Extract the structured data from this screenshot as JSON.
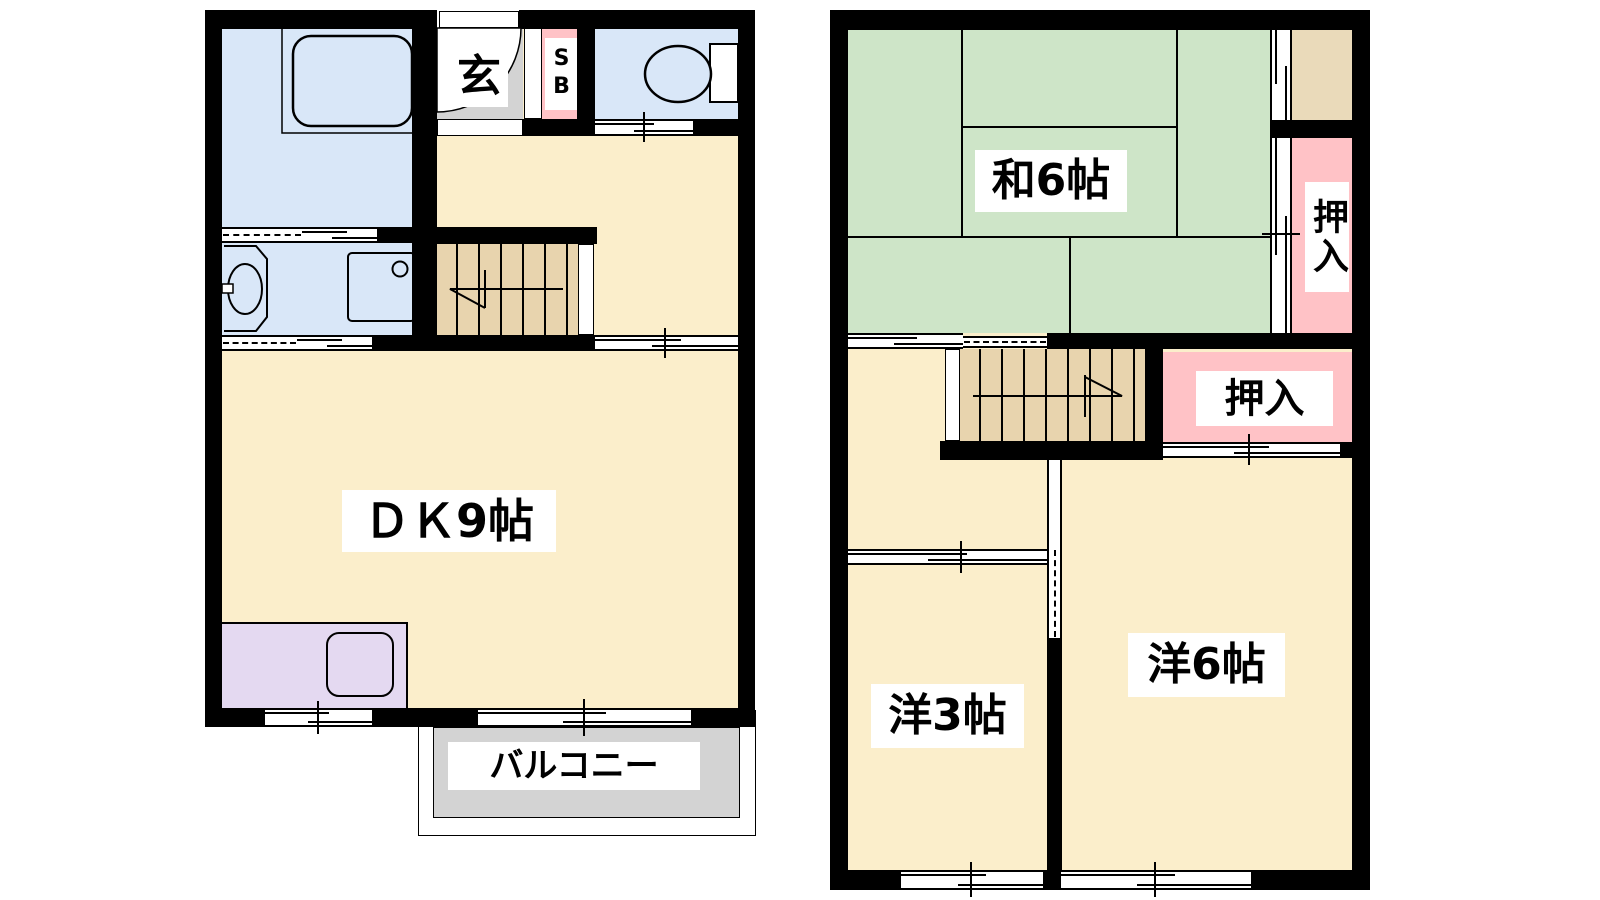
{
  "floor1": {
    "rooms": {
      "dining_kitchen": {
        "label": "ＤＫ9帖"
      },
      "entrance": {
        "label": "玄"
      },
      "shoe_box": {
        "label": "SB"
      },
      "balcony": {
        "label": "バルコニー"
      }
    }
  },
  "floor2": {
    "rooms": {
      "japanese_room": {
        "label": "和6帖"
      },
      "closet_upper": {
        "label": "押入"
      },
      "closet_lower": {
        "label": "押入"
      },
      "western_room_3": {
        "label": "洋3帖"
      },
      "western_room_6": {
        "label": "洋6帖"
      }
    }
  },
  "colors": {
    "wall": "#000000",
    "blue": "#d9e7f8",
    "cream": "#fbeecb",
    "green": "#cee5c8",
    "pink": "#ffc2c6",
    "stair": "#e8d4ae",
    "alcove": "#eadaba",
    "purple": "#e4d9f1",
    "gray": "#d3d3d3"
  }
}
